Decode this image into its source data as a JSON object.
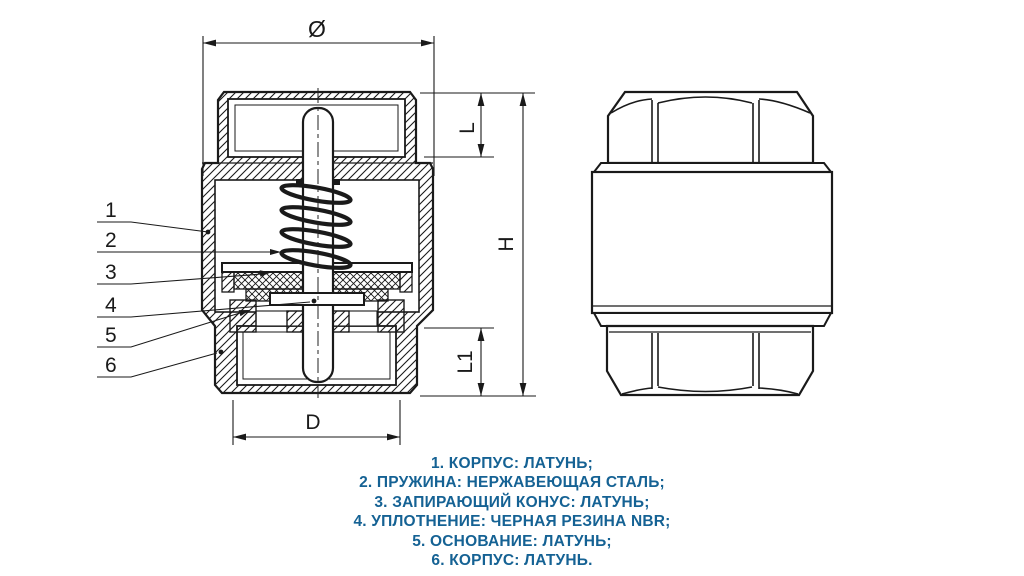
{
  "colors": {
    "line": "#1a1a1a",
    "background": "#ffffff",
    "legend_text": "#156294"
  },
  "drawing": {
    "dimensions": {
      "outer_diameter": "Ø",
      "top_thread_length": "L",
      "total_height": "H",
      "bottom_thread_length": "L1",
      "bottom_diameter": "D"
    },
    "callouts": [
      "1",
      "2",
      "3",
      "4",
      "5",
      "6"
    ]
  },
  "legend": {
    "items": [
      "1. КОРПУС: ЛАТУНЬ;",
      "2. ПРУЖИНА: НЕРЖАВЕЮЩАЯ СТАЛЬ;",
      "3. ЗАПИРАЮЩИЙ КОНУС: ЛАТУНЬ;",
      "4. УПЛОТНЕНИЕ: ЧЕРНАЯ РЕЗИНА NBR;",
      "5. ОСНОВАНИЕ: ЛАТУНЬ;",
      "6. КОРПУС: ЛАТУНЬ."
    ]
  }
}
